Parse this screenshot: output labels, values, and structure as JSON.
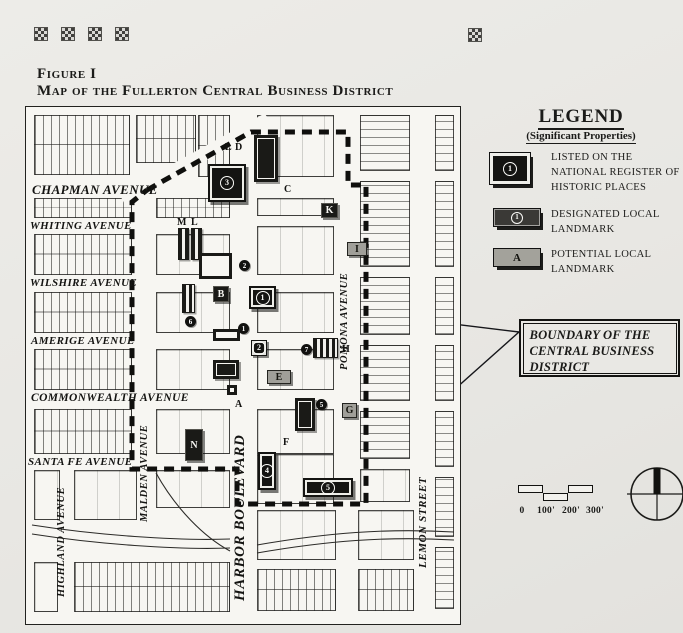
{
  "page": {
    "background": "#e8e7e3",
    "ink": "#1b1b19",
    "ornament_glyph": "checker-square",
    "ornament_positions": [
      [
        34,
        27
      ],
      [
        61,
        27
      ],
      [
        88,
        27
      ],
      [
        115,
        27
      ],
      [
        468,
        28
      ]
    ]
  },
  "figure": {
    "label": "Figure I",
    "title": "Map of the Fullerton Central Business District"
  },
  "legend": {
    "title": "LEGEND",
    "subtitle": "(Significant Properties)",
    "items": [
      {
        "symbol": "1",
        "style": "national",
        "label": "LISTED ON THE NATIONAL REGISTER OF HISTORIC PLACES"
      },
      {
        "symbol": "1",
        "style": "designated",
        "label": "DESIGNATED LOCAL LANDMARK"
      },
      {
        "symbol": "A",
        "style": "potential",
        "label": "POTENTIAL LOCAL LANDMARK"
      }
    ]
  },
  "callout": {
    "text": "BOUNDARY OF THE CENTRAL BUSINESS DISTRICT",
    "pointer_lines": [
      [
        519,
        332,
        371,
        314
      ],
      [
        519,
        332,
        372,
        463
      ]
    ]
  },
  "scale_bar": {
    "labels": [
      "0",
      "100'",
      "200'",
      "300'"
    ]
  },
  "compass": {
    "label": "north-arrow"
  },
  "map": {
    "boundary_points": "121,83 225,25 322,25 322,78 340,78 340,397 211,397 211,362 106,362 106,95 121,83",
    "diagonal_road": [
      96,
      92,
      242,
      12
    ],
    "railroads": [
      "M6,418 C70,428 150,434 204,432",
      "M6,427 C70,437 150,443 204,441",
      "M231,438 C300,426 360,421 428,425",
      "M231,446 C300,434 360,429 428,433",
      "M130,366 C150,402 178,430 204,444"
    ],
    "streets": {
      "horizontal": [
        {
          "name": "CHAPMAN AVENUE",
          "x": 6,
          "y": 75,
          "size": 13
        },
        {
          "name": "WHITING AVENUE",
          "x": 4,
          "y": 113,
          "size": 11
        },
        {
          "name": "WILSHIRE AVENUE",
          "x": 4,
          "y": 170,
          "size": 11
        },
        {
          "name": "AMERIGE AVENUE",
          "x": 5,
          "y": 228,
          "size": 11
        },
        {
          "name": "COMMONWEALTH AVENUE",
          "x": 5,
          "y": 285,
          "size": 11.5
        },
        {
          "name": "SANTA FE AVENUE",
          "x": 2,
          "y": 349,
          "size": 11
        }
      ],
      "vertical": [
        {
          "name": "HIGHLAND AVENUE",
          "x": 30,
          "y": 365,
          "h": 140,
          "size": 10.5
        },
        {
          "name": "MALDEN AVENUE",
          "x": 113,
          "y": 314,
          "h": 104,
          "size": 10.5
        },
        {
          "name": "HARBOR BOULEVARD",
          "x": 206,
          "y": 318,
          "h": 186,
          "size": 15
        },
        {
          "name": "POMONA AVENUE",
          "x": 313,
          "y": 114,
          "h": 200,
          "size": 10.5
        },
        {
          "name": "LEMON STREET",
          "x": 391,
          "y": 346,
          "h": 138,
          "size": 11
        }
      ]
    },
    "blocks": [
      {
        "x": 8,
        "y": 8,
        "w": 96,
        "h": 60,
        "s": "v"
      },
      {
        "x": 110,
        "y": 8,
        "w": 60,
        "h": 48,
        "s": "v"
      },
      {
        "x": 172,
        "y": 8,
        "w": 32,
        "h": 62,
        "s": "v"
      },
      {
        "x": 231,
        "y": 8,
        "w": 77,
        "h": 62,
        "s": "plain"
      },
      {
        "x": 334,
        "y": 8,
        "w": 50,
        "h": 56,
        "s": "h"
      },
      {
        "x": 409,
        "y": 8,
        "w": 19,
        "h": 56,
        "s": "h"
      },
      {
        "x": 8,
        "y": 91,
        "w": 98,
        "h": 20,
        "s": "v"
      },
      {
        "x": 130,
        "y": 91,
        "w": 74,
        "h": 20,
        "s": "v"
      },
      {
        "x": 231,
        "y": 91,
        "w": 77,
        "h": 18,
        "s": "plain"
      },
      {
        "x": 334,
        "y": 74,
        "w": 50,
        "h": 86,
        "s": "h"
      },
      {
        "x": 409,
        "y": 74,
        "w": 19,
        "h": 86,
        "s": "h"
      },
      {
        "x": 8,
        "y": 127,
        "w": 98,
        "h": 41,
        "s": "v"
      },
      {
        "x": 130,
        "y": 127,
        "w": 74,
        "h": 41,
        "s": "plain"
      },
      {
        "x": 231,
        "y": 119,
        "w": 77,
        "h": 49,
        "s": "plain"
      },
      {
        "x": 334,
        "y": 170,
        "w": 50,
        "h": 58,
        "s": "h"
      },
      {
        "x": 409,
        "y": 170,
        "w": 19,
        "h": 58,
        "s": "h"
      },
      {
        "x": 8,
        "y": 185,
        "w": 98,
        "h": 41,
        "s": "v"
      },
      {
        "x": 130,
        "y": 185,
        "w": 74,
        "h": 41,
        "s": "plain"
      },
      {
        "x": 231,
        "y": 185,
        "w": 77,
        "h": 41,
        "s": "plain"
      },
      {
        "x": 334,
        "y": 238,
        "w": 50,
        "h": 56,
        "s": "h"
      },
      {
        "x": 409,
        "y": 238,
        "w": 19,
        "h": 56,
        "s": "h"
      },
      {
        "x": 8,
        "y": 242,
        "w": 98,
        "h": 41,
        "s": "v"
      },
      {
        "x": 130,
        "y": 242,
        "w": 74,
        "h": 41,
        "s": "plain"
      },
      {
        "x": 231,
        "y": 242,
        "w": 77,
        "h": 41,
        "s": "plain"
      },
      {
        "x": 334,
        "y": 304,
        "w": 50,
        "h": 48,
        "s": "h"
      },
      {
        "x": 409,
        "y": 304,
        "w": 19,
        "h": 56,
        "s": "h"
      },
      {
        "x": 8,
        "y": 302,
        "w": 98,
        "h": 45,
        "s": "v"
      },
      {
        "x": 130,
        "y": 302,
        "w": 74,
        "h": 45,
        "s": "plain"
      },
      {
        "x": 231,
        "y": 302,
        "w": 77,
        "h": 45,
        "s": "plain"
      },
      {
        "x": 231,
        "y": 347,
        "w": 77,
        "h": 50,
        "s": "plain"
      },
      {
        "x": 334,
        "y": 362,
        "w": 50,
        "h": 33,
        "s": "plain"
      },
      {
        "x": 409,
        "y": 370,
        "w": 19,
        "h": 60,
        "s": "h"
      },
      {
        "x": 8,
        "y": 363,
        "w": 26,
        "h": 50,
        "s": "plain"
      },
      {
        "x": 48,
        "y": 363,
        "w": 63,
        "h": 50,
        "s": "plain"
      },
      {
        "x": 130,
        "y": 363,
        "w": 74,
        "h": 38,
        "s": "plain"
      },
      {
        "x": 231,
        "y": 403,
        "w": 79,
        "h": 50,
        "s": "plain"
      },
      {
        "x": 332,
        "y": 403,
        "w": 56,
        "h": 50,
        "s": "plain"
      },
      {
        "x": 409,
        "y": 440,
        "w": 19,
        "h": 62,
        "s": "h"
      },
      {
        "x": 8,
        "y": 455,
        "w": 24,
        "h": 50,
        "s": "plain"
      },
      {
        "x": 48,
        "y": 455,
        "w": 156,
        "h": 50,
        "s": "v"
      },
      {
        "x": 231,
        "y": 462,
        "w": 79,
        "h": 42,
        "s": "v"
      },
      {
        "x": 332,
        "y": 462,
        "w": 56,
        "h": 42,
        "s": "v"
      }
    ],
    "landmarks": [
      {
        "kind": "nr-big",
        "text": "3",
        "x": 182,
        "y": 57,
        "w": 38,
        "h": 38
      },
      {
        "kind": "bldg-black",
        "text": "",
        "x": 228,
        "y": 28,
        "w": 24,
        "h": 47
      },
      {
        "kind": "label",
        "text": "C",
        "x": 258,
        "y": 77
      },
      {
        "kind": "label",
        "text": "L",
        "x": 199,
        "y": 35
      },
      {
        "kind": "label",
        "text": "D",
        "x": 209,
        "y": 35
      },
      {
        "kind": "label",
        "text": "M",
        "x": 151,
        "y": 110
      },
      {
        "kind": "label",
        "text": "L",
        "x": 165,
        "y": 110
      },
      {
        "kind": "bldg-striped",
        "text": "",
        "x": 152,
        "y": 121,
        "w": 11,
        "h": 32
      },
      {
        "kind": "bldg-striped",
        "text": "",
        "x": 165,
        "y": 121,
        "w": 11,
        "h": 32
      },
      {
        "kind": "letter-dark",
        "text": "K",
        "x": 295,
        "y": 96,
        "w": 17,
        "h": 15
      },
      {
        "kind": "letter-gray",
        "text": "I",
        "x": 321,
        "y": 135,
        "w": 20,
        "h": 14
      },
      {
        "kind": "bldg-frame",
        "text": "",
        "x": 173,
        "y": 146,
        "w": 33,
        "h": 26
      },
      {
        "kind": "nr-dot",
        "text": "2",
        "x": 213,
        "y": 153
      },
      {
        "kind": "letter-dark",
        "text": "B",
        "x": 187,
        "y": 179,
        "w": 16,
        "h": 16
      },
      {
        "kind": "bldg-striped",
        "text": "",
        "x": 156,
        "y": 177,
        "w": 13,
        "h": 29
      },
      {
        "kind": "nr-dot",
        "text": "6",
        "x": 159,
        "y": 209
      },
      {
        "kind": "nr-big",
        "text": "1",
        "x": 223,
        "y": 179,
        "w": 27,
        "h": 23
      },
      {
        "kind": "nr-dot",
        "text": "1",
        "x": 212,
        "y": 216
      },
      {
        "kind": "bldg-frame",
        "text": "",
        "x": 187,
        "y": 222,
        "w": 27,
        "h": 12
      },
      {
        "kind": "nr-box",
        "text": "2",
        "x": 225,
        "y": 233,
        "w": 16,
        "h": 16
      },
      {
        "kind": "nr-dot",
        "text": "7",
        "x": 275,
        "y": 237
      },
      {
        "kind": "bldg-striped",
        "text": "",
        "x": 287,
        "y": 231,
        "w": 25,
        "h": 20
      },
      {
        "kind": "label",
        "text": "H",
        "x": 316,
        "y": 237
      },
      {
        "kind": "bldg-black",
        "text": "",
        "x": 187,
        "y": 253,
        "w": 26,
        "h": 19
      },
      {
        "kind": "letter-gray",
        "text": "E",
        "x": 241,
        "y": 263,
        "w": 24,
        "h": 14
      },
      {
        "kind": "bldg-frame",
        "text": "",
        "x": 201,
        "y": 278,
        "w": 10,
        "h": 10
      },
      {
        "kind": "label",
        "text": "A",
        "x": 209,
        "y": 292
      },
      {
        "kind": "nr-dot",
        "text": "5",
        "x": 290,
        "y": 292
      },
      {
        "kind": "bldg-black",
        "text": "",
        "x": 269,
        "y": 291,
        "w": 20,
        "h": 33
      },
      {
        "kind": "letter-gray",
        "text": "G",
        "x": 316,
        "y": 296,
        "w": 15,
        "h": 15
      },
      {
        "kind": "label",
        "text": "F",
        "x": 257,
        "y": 330
      },
      {
        "kind": "letter-dark",
        "text": "N",
        "x": 159,
        "y": 322,
        "w": 18,
        "h": 32
      },
      {
        "kind": "nr-big",
        "text": "4",
        "x": 232,
        "y": 345,
        "w": 18,
        "h": 38
      },
      {
        "kind": "nr-big",
        "text": "5",
        "x": 277,
        "y": 371,
        "w": 50,
        "h": 19
      }
    ]
  }
}
